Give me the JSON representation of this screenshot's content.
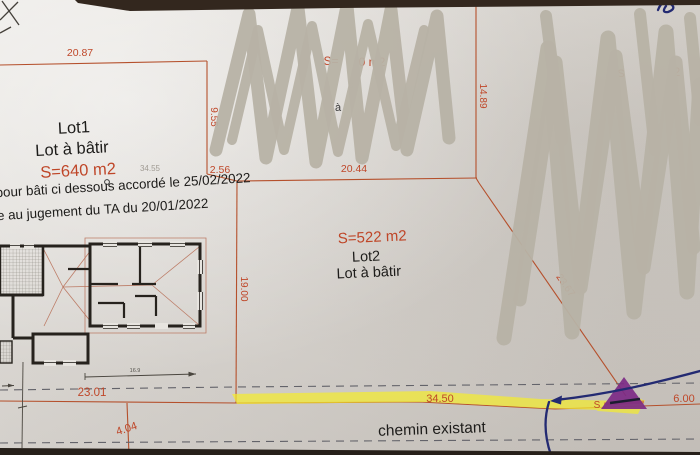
{
  "document_type": "cadastral division plan (photo)",
  "lots": {
    "lot1": {
      "name": "Lot1",
      "designation": "Lot à bâtir",
      "area": "S=640 m2",
      "inner_dim": "34.55"
    },
    "lot2": {
      "name": "Lot2",
      "designation": "Lot à bâtir",
      "area": "S=522 m2"
    }
  },
  "annotations": {
    "note_line1": "pour bâti ci dessous accordé le 25/02/2022",
    "note_line2": "e au jugement du TA du 20/01/2022",
    "road_label": "chemin existant"
  },
  "measurements": {
    "m2087": "20.87",
    "m955": "9.55",
    "m256": "2.56",
    "m2044": "20.44",
    "m1489": "14.89",
    "m1900": "19.00",
    "m2367": "23.67",
    "m2301": "23.01",
    "m3450": "34.50",
    "m404": "4.04",
    "m600": "6.00",
    "m169": "16.9"
  },
  "masked_fragments": {
    "red_s_eq": "S=",
    "red_0m2": "0 m2",
    "black_c": "c",
    "black_a": "à",
    "right_red_s": "S",
    "right_red_2": "2",
    "marker_red_s": "S"
  },
  "colors": {
    "boundary_red": "#b5502c",
    "text_red": "#bf4628",
    "scribble_grey": "#b7b2a5",
    "highlight_yellow": "#f4ec2f",
    "marker_purple": "#7c2a85",
    "pen_blue": "#232a72",
    "paper": "#e7e4df",
    "background": "#2a211a"
  }
}
